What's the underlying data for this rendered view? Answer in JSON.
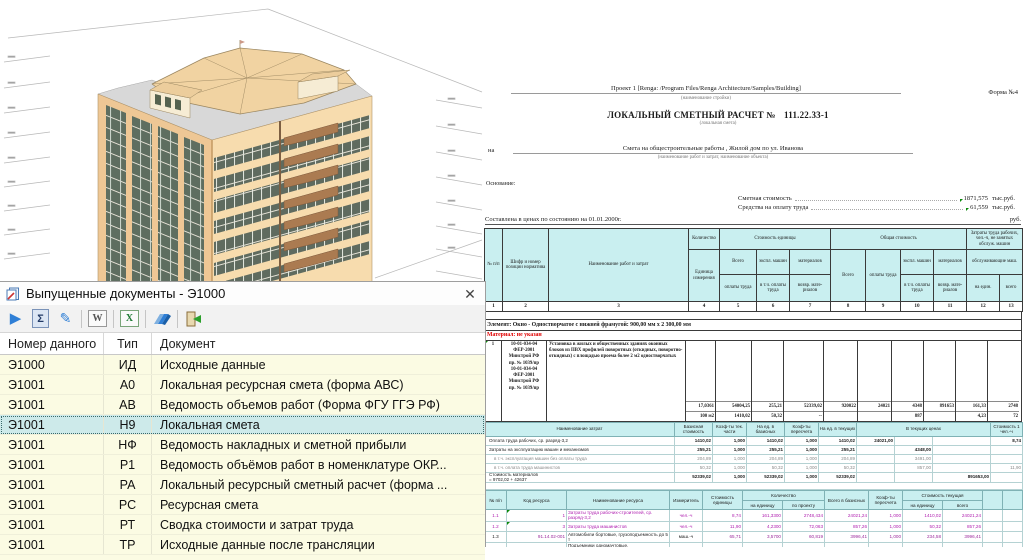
{
  "colors": {
    "table_header_fill": "#c9eff0",
    "selected_row": "#cdeaea",
    "row_yellow": "#fbfbe3",
    "magenta_text": "#b020b0",
    "red_text": "#e00000",
    "green_marker": "#0a8a0a",
    "wall": "#f7dcae",
    "roof": "#f1d3a2",
    "balcony": "#ab7b51"
  },
  "docs_panel": {
    "title": "Выпущенные документы - Э1000",
    "close_glyph": "✕",
    "toolbar": [
      {
        "name": "run",
        "glyph": "▶"
      },
      {
        "name": "sum",
        "glyph": "Σ"
      },
      {
        "name": "edit",
        "glyph": "✎"
      },
      {
        "name": "word-export",
        "glyph": "W"
      },
      {
        "name": "excel-export",
        "glyph": "X"
      },
      {
        "name": "batch",
        "glyph": ""
      },
      {
        "name": "export-exit",
        "glyph": ""
      }
    ],
    "columns": {
      "num": "Номер данного",
      "type": "Тип",
      "doc": "Документ"
    },
    "rows": [
      {
        "num": "Э1000",
        "type": "ИД",
        "doc": "Исходные данные"
      },
      {
        "num": "Э1001",
        "type": "А0",
        "doc": "Локальная ресурсная смета (форма АВС)"
      },
      {
        "num": "Э1001",
        "type": "АВ",
        "doc": "Ведомость объемов работ (Форма ФГУ ГГЭ РФ)"
      },
      {
        "num": "Э1001",
        "type": "Н9",
        "doc": "Локальная смета",
        "cls": "selected"
      },
      {
        "num": "Э1001",
        "type": "НФ",
        "doc": "Ведомость накладных и сметной прибыли"
      },
      {
        "num": "Э1001",
        "type": "Р1",
        "doc": "Ведомость объёмов работ в номенклатуре ОКР..."
      },
      {
        "num": "Э1001",
        "type": "РА",
        "doc": "Локальный ресурсный сметный расчет (форма ..."
      },
      {
        "num": "Э1001",
        "type": "РС",
        "doc": "Ресурсная смета"
      },
      {
        "num": "Э1001",
        "type": "РТ",
        "doc": "Сводка стоимости и затрат труда"
      },
      {
        "num": "Э1001",
        "type": "ТР",
        "doc": "Исходные данные после трансляции"
      }
    ]
  },
  "document": {
    "form_label": "Форма №4",
    "project_line": "Проект 1 [Renga: /Program Files/Renga Architecture/Samples/Building]",
    "project_caption": "(наименование стройки)",
    "title": "ЛОКАЛЬНЫЙ СМЕТНЫЙ РАСЧЕТ №",
    "title_number": "111.22.33-1",
    "title_caption": "(локальная смета)",
    "na_label": "на",
    "subject_line": "Смета на общестроительные работы , Жилой дом по ул. Иванова",
    "subject_caption": "(наименование работ и затрат, наименование объекта)",
    "basis_label": "Основание:",
    "cost_label": "Сметная стоимость",
    "cost_value": "1871,575",
    "cost_units": "тыс.руб.",
    "labor_label": "Средства на оплату труда",
    "labor_value": "61,559",
    "labor_units": "тыс.руб.",
    "prices_line": "Составлена в ценах по состоянию на 01.01.2000г.",
    "rub_label": "руб."
  },
  "main_table": {
    "headers": {
      "npp": "№ п/п",
      "code": "Шифр и номер позиции норматива",
      "name": "Наименование работ и затрат",
      "qty": "Количество",
      "unit": "Единица измерения",
      "unit_cost": "Стоимость единицы",
      "total_cost": "Общая стоимость",
      "vsego": "Всего",
      "oplaty": "оплаты труда",
      "ekspl": "экспл. машин",
      "vtch": "в т.ч. оплаты труда",
      "mater": "материалов",
      "vozvr": "возвр. мате- риалов",
      "labor_group": "Затраты труда рабочих, чел.-ч, не занятых обслуж. машин",
      "labor_sub": "обслуживающие маш.",
      "per_unit": "на един.",
      "total": "всего"
    },
    "col_numbers": [
      "1",
      "2",
      "3",
      "4",
      "5",
      "6",
      "7",
      "8",
      "9",
      "10",
      "11",
      "12",
      "13"
    ],
    "element_line": "Элемент: Окно - Одностворчатое с нижней фрамугой: 900,00 мм х 2 300,00 мм",
    "material_line": "Материал: не указан",
    "row1": {
      "npp": "1",
      "code_lines": [
        "10-01-034-04",
        "ФЕР-2001",
        "Минстрой РФ",
        "пр. № 1039/пр",
        "10-01-034-04",
        "ФЕР-2001",
        "Минстрой РФ",
        "пр. № 1039/пр"
      ],
      "name": "Установка в жилых и общественных зданиях оконных блоков из ПВХ профилей поворотных (откидных, поворотно-откидных) с площадью проема более 2 м2 одностворчатых",
      "line1": [
        "17,0361",
        "54004,25",
        "255,21",
        "52339,02",
        "920022",
        "24021",
        "4348",
        "891653",
        "161,33",
        "2748"
      ],
      "line2": [
        "100 м2",
        "1410,02",
        "50,32",
        "--",
        "",
        "",
        "887",
        "",
        "4,23",
        "72"
      ]
    }
  },
  "cost_breakdown": {
    "headers": {
      "name": "Наименование затрат",
      "base": "Базисная стоимость",
      "coef_cur": "Коэф-ты тек. части",
      "per_base": "На ед. в базисных",
      "coef_recalc": "Коэф-ты пересчета",
      "per_cur": "На ед. в текущих",
      "in_cur": "В текущих ценах",
      "cost_1h": "Стоимость 1 чел.-ч"
    },
    "rows": [
      {
        "name": "Оплата труда рабочих, ср. разряд-3,2",
        "b": "1410,02",
        "k1": "1,000",
        "eb": "1410,02",
        "k2": "1,000",
        "et": "1410,02",
        "t1": "24021,00",
        "t2": "",
        "t3": "",
        "s1": "8,74"
      },
      {
        "name": "Затраты на эксплуатацию машин и механизмов",
        "b": "255,21",
        "k1": "1,000",
        "eb": "255,21",
        "k2": "1,000",
        "et": "255,21",
        "t1": "",
        "t2": "4348,00",
        "t3": "",
        "s1": ""
      },
      {
        "name": "в т.ч. эксплуатация машин без оплаты труда",
        "cls": "sub",
        "b": "204,89",
        "k1": "1,000",
        "eb": "204,89",
        "k2": "1,000",
        "et": "204,89",
        "t1": "",
        "t2": "3491,00",
        "t3": "",
        "s1": ""
      },
      {
        "name": "в т.ч. оплата труда машинистов",
        "cls": "sub",
        "b": "50,32",
        "k1": "1,000",
        "eb": "50,32",
        "k2": "1,000",
        "et": "50,32",
        "t1": "",
        "t2": "857,00",
        "t3": "",
        "s1": "11,90"
      },
      {
        "name": "Стоимость материалов",
        "name2": "= 9702,02 + 42637",
        "b": "52339,02",
        "k1": "1,000",
        "eb": "52339,02",
        "k2": "1,000",
        "et": "52339,02",
        "t1": "",
        "t2": "",
        "t3": "891653,00",
        "s1": ""
      }
    ]
  },
  "resources": {
    "headers": {
      "npp": "№ п/п",
      "code": "Код ресурса",
      "name": "Наименование ресурса",
      "unit": "Измеритель",
      "unit_cost": "Стоимость единицы",
      "qty": "Количество",
      "qty_per_unit": "на единицу",
      "qty_project": "по проекту",
      "total_base": "Всего в базисных",
      "coef": "Коэф-ты пересчета",
      "cur": "Стоимость текущая",
      "cur_per_unit": "на единицу",
      "cur_total": "всего"
    },
    "rows": [
      {
        "n": "1.1",
        "code": "1",
        "name": "Затраты труда рабочих-строителей, ср. разряд-3,2",
        "unit": "чел.-ч",
        "uc": "8,74",
        "qu": "161,3300",
        "qp": "2748,434",
        "tb": "24021,24",
        "k": "1,000",
        "cu": "1410,02",
        "ct": "24021,24",
        "cls": "magenta mk"
      },
      {
        "n": "1.2",
        "code": "3",
        "name": "Затраты труда машинистов",
        "unit": "чел.-ч",
        "uc": "11,90",
        "qu": "4,2300",
        "qp": "72,063",
        "tb": "857,26",
        "k": "1,000",
        "cu": "50,32",
        "ct": "857,26",
        "cls": "magenta mk"
      },
      {
        "n": "1.3",
        "code": "91.14.02-001",
        "name": "Автомобили бортовые, грузоподъемность до 5 т",
        "unit": "маш.-ч",
        "uc": "65,71",
        "qu": "3,5700",
        "qp": "60,819",
        "tb": "3996,41",
        "k": "1,000",
        "cu": "234,58",
        "ct": "3996,41"
      },
      {
        "n": "1.4",
        "code": "91.06.06-048",
        "name": "Подъемники одномачтовые, грузоподъемность до 500 кг, высота подъема 45 м",
        "unit": "маш.-ч",
        "uc": "31,26",
        "qu": "0,6600",
        "qp": "11,244",
        "tb": "351,48",
        "k": "1,000",
        "cu": "20,63",
        "ct": "351,48"
      },
      {
        "n": "1.5",
        "code": "11.3.03.15-0021",
        "name": "Крепежные изделия для оконных блоков",
        "unit": "100 шт",
        "uc": "80,00",
        "qu": "4,0000",
        "qp": "136,289",
        "tb": "6814,44",
        "k": "1,000",
        "cu": "400,00",
        "ct": "6814,44",
        "cls": "clip"
      }
    ]
  }
}
